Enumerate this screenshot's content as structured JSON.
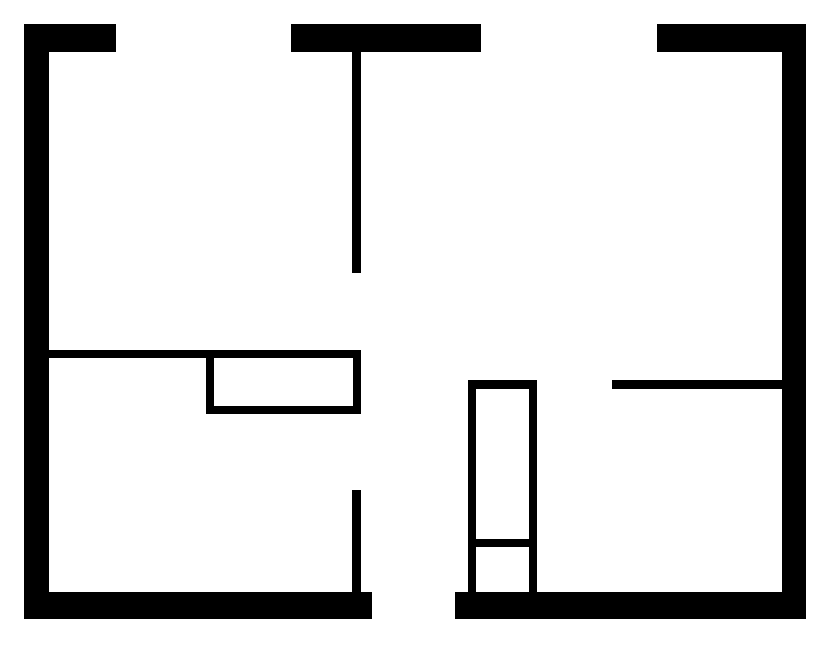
{
  "canvas": {
    "width": 835,
    "height": 646,
    "background_color": "#ffffff",
    "wall_color": "#000000"
  },
  "floor_plan": {
    "type": "floor-plan",
    "description": "black wall segments of an apartment floor plan on a white background",
    "walls": [
      {
        "name": "top-wall-segment-left",
        "x": 24,
        "y": 24,
        "w": 92,
        "h": 28
      },
      {
        "name": "top-wall-segment-middle",
        "x": 291,
        "y": 24,
        "w": 190,
        "h": 28
      },
      {
        "name": "top-wall-segment-right",
        "x": 657,
        "y": 24,
        "w": 149,
        "h": 28
      },
      {
        "name": "left-exterior-wall",
        "x": 24,
        "y": 24,
        "w": 25,
        "h": 595
      },
      {
        "name": "right-exterior-wall",
        "x": 782,
        "y": 24,
        "w": 24,
        "h": 595
      },
      {
        "name": "bottom-wall-segment-left",
        "x": 24,
        "y": 592,
        "w": 348,
        "h": 27
      },
      {
        "name": "bottom-wall-segment-right",
        "x": 455,
        "y": 592,
        "w": 351,
        "h": 27
      },
      {
        "name": "center-partition-upper",
        "x": 352,
        "y": 52,
        "w": 9,
        "h": 221
      },
      {
        "name": "left-room-divider-wall",
        "x": 49,
        "y": 350,
        "w": 312,
        "h": 8
      },
      {
        "name": "counter-left-edge",
        "x": 206,
        "y": 350,
        "w": 8,
        "h": 64
      },
      {
        "name": "counter-bottom-edge",
        "x": 206,
        "y": 406,
        "w": 155,
        "h": 8
      },
      {
        "name": "counter-right-edge",
        "x": 353,
        "y": 350,
        "w": 8,
        "h": 64
      },
      {
        "name": "center-partition-lower",
        "x": 352,
        "y": 490,
        "w": 9,
        "h": 102
      },
      {
        "name": "closet-left-edge",
        "x": 468,
        "y": 380,
        "w": 8,
        "h": 212
      },
      {
        "name": "closet-right-edge",
        "x": 529,
        "y": 380,
        "w": 8,
        "h": 212
      },
      {
        "name": "closet-top-edge",
        "x": 468,
        "y": 380,
        "w": 69,
        "h": 9
      },
      {
        "name": "closet-shelf-divider",
        "x": 468,
        "y": 539,
        "w": 69,
        "h": 8
      },
      {
        "name": "right-room-wall",
        "x": 612,
        "y": 380,
        "w": 170,
        "h": 9
      }
    ]
  }
}
